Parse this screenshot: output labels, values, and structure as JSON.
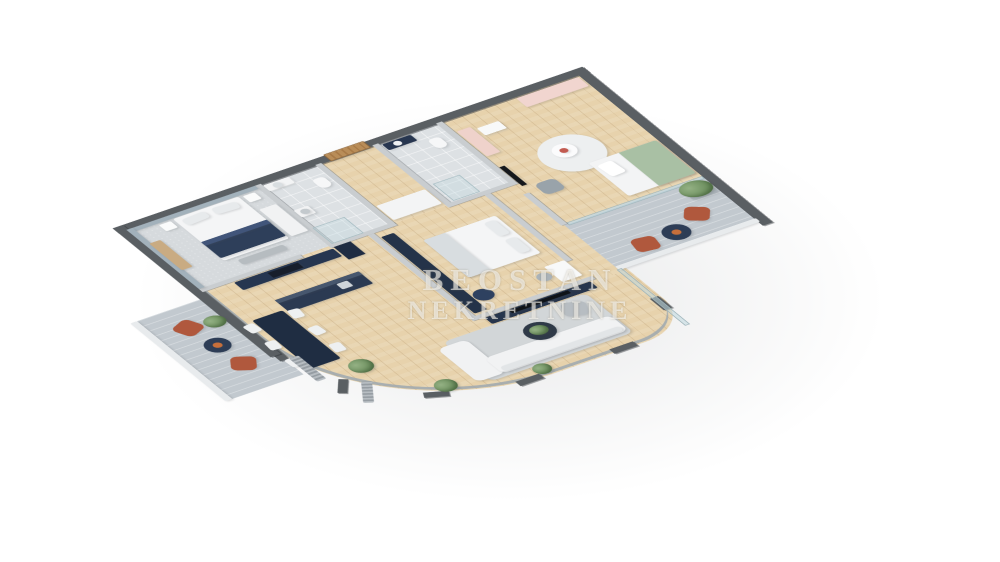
{
  "watermark": {
    "line1": "BEOSTAN",
    "line2": "NEKRETNINE"
  },
  "palette": {
    "background": "#ffffff",
    "exterior_wall": "#5a5f63",
    "interior_wall": "#c9cdd0",
    "wood_floor": "#e7d2ac",
    "tile_floor": "#dde1e4",
    "terrace_floor": "#c2c9cf",
    "navy_furniture": "#263650",
    "terracotta_chair": "#b0583d",
    "pink_furniture": "#f1d5cf",
    "green_bedding": "#a9c0a4",
    "plant_green": "#678a59"
  },
  "plan": {
    "width": 540,
    "height": 540,
    "items": [
      {
        "n": "living-kitchen-floor",
        "cls": "wood",
        "x": 0,
        "y": 136,
        "w": 380,
        "h": 324,
        "r": "0 0 60px 215px"
      },
      {
        "n": "hall-lower-floor",
        "cls": "wood",
        "x": 296,
        "y": 136,
        "w": 80,
        "h": 200
      },
      {
        "n": "master-bedroom-floor",
        "cls": "carpet",
        "x": 0,
        "y": 0,
        "w": 156,
        "h": 136
      },
      {
        "n": "bathroom-1-floor",
        "cls": "tile",
        "x": 156,
        "y": 0,
        "w": 72,
        "h": 136
      },
      {
        "n": "hallway-floor",
        "cls": "wood",
        "x": 228,
        "y": 0,
        "w": 68,
        "h": 136
      },
      {
        "n": "bathroom-2-floor",
        "cls": "tile",
        "x": 296,
        "y": 0,
        "w": 76,
        "h": 136
      },
      {
        "n": "kids-room-floor",
        "cls": "wood",
        "x": 372,
        "y": 0,
        "w": 168,
        "h": 230
      },
      {
        "n": "central-bedroom-floor",
        "cls": "wood",
        "x": 200,
        "y": 136,
        "w": 140,
        "h": 194
      },
      {
        "n": "right-terrace-floor",
        "cls": "terrace",
        "x": 372,
        "y": 230,
        "w": 168,
        "h": 100
      },
      {
        "n": "left-terrace-floor",
        "cls": "terrace",
        "x": -85,
        "y": 150,
        "w": 85,
        "h": 175
      },
      {
        "n": "curved-glass-wall",
        "cls": "glassring",
        "x": 0,
        "y": 136,
        "w": 376,
        "h": 322,
        "r": "0 0 60px 215px"
      },
      {
        "n": "window-pier-1",
        "cls": "wall",
        "x": -6,
        "y": 262,
        "w": 10,
        "h": 30
      },
      {
        "n": "window-pier-2",
        "cls": "wall",
        "x": 16,
        "y": 352,
        "w": 10,
        "h": 26,
        "rot": 35
      },
      {
        "n": "window-pier-3",
        "cls": "wall",
        "x": 78,
        "y": 424,
        "w": 26,
        "h": 10,
        "rot": 25
      },
      {
        "n": "window-pier-4",
        "cls": "wall",
        "x": 170,
        "y": 452,
        "w": 28,
        "h": 10
      },
      {
        "n": "window-pier-5",
        "cls": "wall",
        "x": 282,
        "y": 452,
        "w": 28,
        "h": 10
      },
      {
        "n": "window-pier-6",
        "cls": "wall",
        "x": 368,
        "y": 394,
        "w": 10,
        "h": 26
      },
      {
        "n": "exterior-wall-top",
        "cls": "wall",
        "x": -10,
        "y": -10,
        "w": 560,
        "h": 12
      },
      {
        "n": "exterior-wall-left",
        "cls": "wall",
        "x": -10,
        "y": -10,
        "w": 12,
        "h": 290
      },
      {
        "n": "exterior-wall-right",
        "cls": "wall",
        "x": 538,
        "y": -10,
        "w": 12,
        "h": 350
      },
      {
        "n": "right-terrace-parapet",
        "c": "#e8ebed",
        "x": 372,
        "y": 324,
        "w": 168,
        "h": 8,
        "r": "2px"
      },
      {
        "n": "left-terrace-parapet",
        "c": "#e8ebed",
        "x": -93,
        "y": 150,
        "w": 8,
        "h": 175,
        "r": "2px"
      },
      {
        "n": "kids-terrace-window",
        "cls": "glass",
        "x": 376,
        "y": 228,
        "w": 162,
        "h": 6
      },
      {
        "n": "living-terrace-window",
        "cls": "glass",
        "x": 370,
        "y": 330,
        "w": 6,
        "h": 126
      },
      {
        "n": "partition-bedroom-bath1",
        "cls": "iwall",
        "x": 153,
        "y": 0,
        "w": 7,
        "h": 136
      },
      {
        "n": "partition-bath1-hall",
        "cls": "iwall",
        "x": 225,
        "y": 0,
        "w": 7,
        "h": 136
      },
      {
        "n": "partition-hall-bath2",
        "cls": "iwall",
        "x": 293,
        "y": 0,
        "w": 7,
        "h": 136
      },
      {
        "n": "partition-bath2-kids",
        "cls": "iwall",
        "x": 369,
        "y": 0,
        "w": 7,
        "h": 136
      },
      {
        "n": "partition-kids-hall",
        "cls": "iwall",
        "x": 369,
        "y": 160,
        "w": 7,
        "h": 70
      },
      {
        "n": "partition-bedroom-kitchen",
        "cls": "iwall",
        "x": 0,
        "y": 133,
        "w": 120,
        "h": 7
      },
      {
        "n": "partition-bath1-center",
        "cls": "iwall",
        "x": 153,
        "y": 133,
        "w": 79,
        "h": 7
      },
      {
        "n": "partition-bath2-center",
        "cls": "iwall",
        "x": 293,
        "y": 133,
        "w": 83,
        "h": 7
      },
      {
        "n": "partition-centerroom-left",
        "cls": "iwall",
        "x": 197,
        "y": 140,
        "w": 7,
        "h": 190
      },
      {
        "n": "partition-centerroom-right",
        "cls": "iwall",
        "x": 336,
        "y": 140,
        "w": 7,
        "h": 150
      },
      {
        "n": "partition-centerroom-bottom",
        "cls": "iwall",
        "x": 197,
        "y": 326,
        "w": 146,
        "h": 7
      },
      {
        "n": "entrance-door",
        "cls": "door",
        "x": 242,
        "y": -12,
        "w": 48,
        "h": 15,
        "r": "2px"
      },
      {
        "n": "bedroom-accent-wall-top",
        "c": "#a2b1bb",
        "x": 0,
        "y": 0,
        "w": 153,
        "h": 7
      },
      {
        "n": "bedroom-accent-wall-left",
        "c": "#a2b1bb",
        "x": 0,
        "y": 0,
        "w": 7,
        "h": 133
      },
      {
        "n": "bedroom-dresser",
        "c": "#c9ab82",
        "x": 5,
        "y": 34,
        "w": 13,
        "h": 60,
        "r": "2px"
      },
      {
        "n": "master-bed",
        "c": "#f4f5f6",
        "x": 50,
        "y": 8,
        "w": 78,
        "h": 94,
        "r": "3px"
      },
      {
        "n": "master-bed-pillow-left",
        "c": "#e7eaec",
        "x": 56,
        "y": 13,
        "w": 28,
        "h": 13,
        "r": "4px",
        "rot": -4
      },
      {
        "n": "master-bed-pillow-right",
        "c": "#e7eaec",
        "x": 92,
        "y": 13,
        "w": 28,
        "h": 13,
        "r": "4px",
        "rot": 4
      },
      {
        "n": "master-bed-blanket",
        "c": "#2e3f5a",
        "x": 50,
        "y": 60,
        "w": 78,
        "h": 36,
        "r": "2px"
      },
      {
        "n": "master-bed-blanket-fold",
        "c": "#41557a",
        "x": 50,
        "y": 60,
        "w": 78,
        "h": 8
      },
      {
        "n": "nightstand-left",
        "c": "#fafbfb",
        "x": 32,
        "y": 10,
        "w": 14,
        "h": 14,
        "r": "2px"
      },
      {
        "n": "nightstand-right",
        "c": "#fafbfb",
        "x": 132,
        "y": 10,
        "w": 14,
        "h": 14,
        "r": "2px"
      },
      {
        "n": "bedroom-bench",
        "c": "#b6bcc0",
        "x": 62,
        "y": 108,
        "w": 54,
        "h": 11,
        "r": "3px"
      },
      {
        "n": "bedroom-wardrobe",
        "c": "#f1f2f3",
        "x": 132,
        "y": 40,
        "w": 20,
        "h": 60,
        "r": "2px"
      },
      {
        "n": "bathroom-1-vanity",
        "c": "#f3f4f5",
        "x": 160,
        "y": 4,
        "w": 30,
        "h": 13,
        "r": "2px"
      },
      {
        "n": "bathroom-1-sink",
        "c": "#d9dee1",
        "x": 168,
        "y": 6,
        "w": 10,
        "h": 10,
        "r": "50%"
      },
      {
        "n": "bathroom-1-toilet",
        "c": "#f6f7f8",
        "x": 206,
        "y": 22,
        "w": 14,
        "h": 20,
        "r": "5px 5px 7px 7px"
      },
      {
        "n": "washing-machine",
        "c": "#f2f3f4",
        "x": 160,
        "y": 60,
        "w": 17,
        "h": 16,
        "r": "2px"
      },
      {
        "n": "washing-machine-door",
        "c": "#c3c9cd",
        "x": 164,
        "y": 63,
        "w": 10,
        "h": 10,
        "r": "50%"
      },
      {
        "n": "bathroom-1-shower",
        "cls": "glassbox",
        "x": 158,
        "y": 98,
        "w": 38,
        "h": 36
      },
      {
        "n": "hall-cabinet",
        "c": "#f3f4f5",
        "x": 234,
        "y": 98,
        "w": 58,
        "h": 32,
        "r": "2px"
      },
      {
        "n": "bathroom-2-vanity",
        "c": "#273650",
        "x": 302,
        "y": 4,
        "w": 34,
        "h": 13,
        "r": "2px"
      },
      {
        "n": "bathroom-2-sink",
        "c": "#eef0f2",
        "x": 312,
        "y": 6,
        "w": 9,
        "h": 9,
        "r": "50%"
      },
      {
        "n": "bathroom-2-toilet",
        "c": "#f6f7f8",
        "x": 344,
        "y": 22,
        "w": 14,
        "h": 20,
        "r": "5px 5px 7px 7px"
      },
      {
        "n": "bathroom-2-shower",
        "cls": "glassbox",
        "x": 304,
        "y": 94,
        "w": 32,
        "h": 38
      },
      {
        "n": "kids-wardrobe",
        "c": "#f1d5cf",
        "x": 462,
        "y": 4,
        "w": 74,
        "h": 20,
        "r": "2px"
      },
      {
        "n": "kids-shelf",
        "c": "#efd2cb",
        "x": 378,
        "y": 24,
        "w": 16,
        "h": 56,
        "r": "2px"
      },
      {
        "n": "kids-desk",
        "c": "#f8f9f9",
        "x": 398,
        "y": 30,
        "w": 26,
        "h": 16,
        "r": "2px"
      },
      {
        "n": "kids-round-rug",
        "c": "#edeff0",
        "x": 418,
        "y": 86,
        "w": 70,
        "h": 70,
        "r": "50%"
      },
      {
        "n": "kids-round-table",
        "c": "#fbfbfc",
        "x": 436,
        "y": 100,
        "w": 26,
        "h": 26,
        "r": "50%"
      },
      {
        "n": "kids-toys",
        "c": "#c25a50",
        "x": 444,
        "y": 108,
        "w": 9,
        "h": 9,
        "r": "50%"
      },
      {
        "n": "kids-bed",
        "c": "#f3f4f5",
        "x": 456,
        "y": 146,
        "w": 80,
        "h": 74,
        "r": "3px"
      },
      {
        "n": "kids-bed-blanket",
        "c": "#a9c0a4",
        "x": 492,
        "y": 146,
        "w": 44,
        "h": 74,
        "r": "0 3px 3px 0"
      },
      {
        "n": "kids-bed-pillow",
        "c": "#ffffff",
        "x": 461,
        "y": 154,
        "w": 18,
        "h": 26,
        "r": "4px",
        "rot": -5
      },
      {
        "n": "kids-armchair",
        "c": "#99a3aa",
        "x": 388,
        "y": 150,
        "w": 24,
        "h": 24,
        "r": "7px"
      },
      {
        "n": "kids-tv",
        "c": "#15181c",
        "x": 377,
        "y": 104,
        "w": 6,
        "h": 42
      },
      {
        "n": "terrace-plant-pot",
        "c": "#a9b2b8",
        "x": 506,
        "y": 238,
        "w": 30,
        "h": 24,
        "r": "3px"
      },
      {
        "n": "terrace-plant",
        "cls": "plant",
        "x": 502,
        "y": 230,
        "w": 36,
        "h": 30
      },
      {
        "n": "terrace-chair-1",
        "c": "#b0583d",
        "x": 482,
        "y": 272,
        "w": 26,
        "h": 26,
        "r": "7px",
        "rot": 35
      },
      {
        "n": "terrace-chair-2",
        "c": "#b0583d",
        "x": 408,
        "y": 292,
        "w": 26,
        "h": 26,
        "r": "7px",
        "rot": 10
      },
      {
        "n": "terrace-table",
        "c": "#2d3d56",
        "x": 444,
        "y": 288,
        "w": 30,
        "h": 30,
        "r": "50%"
      },
      {
        "n": "terrace-bowl",
        "c": "#c76f3b",
        "x": 454,
        "y": 298,
        "w": 10,
        "h": 10,
        "r": "50%"
      },
      {
        "n": "kitchen-cabinets",
        "c": "#263650",
        "x": 36,
        "y": 142,
        "w": 118,
        "h": 17,
        "r": "2px"
      },
      {
        "n": "kitchen-cooktop",
        "c": "#171e2b",
        "x": 74,
        "y": 145,
        "w": 36,
        "h": 11
      },
      {
        "n": "kitchen-tall-unit",
        "c": "#1f2c42",
        "x": 156,
        "y": 140,
        "w": 20,
        "h": 28
      },
      {
        "n": "kitchen-island",
        "c": "#2b3a52",
        "x": 52,
        "y": 192,
        "w": 100,
        "h": 27,
        "r": "2px"
      },
      {
        "n": "kitchen-island-top",
        "c": "#47576e",
        "x": 52,
        "y": 192,
        "w": 100,
        "h": 7
      },
      {
        "n": "kitchen-sink",
        "c": "#cfd5da",
        "x": 120,
        "y": 200,
        "w": 13,
        "h": 12,
        "r": "2px"
      },
      {
        "n": "dining-table",
        "c": "#1f2d42",
        "x": 12,
        "y": 212,
        "w": 36,
        "h": 108,
        "r": "3px"
      },
      {
        "n": "dining-chair-1",
        "c": "#eef0f1",
        "x": -2,
        "y": 216,
        "w": 13,
        "h": 17,
        "r": "3px",
        "rot": -6
      },
      {
        "n": "dining-chair-2",
        "c": "#eef0f1",
        "x": -2,
        "y": 254,
        "w": 13,
        "h": 17,
        "r": "3px",
        "rot": 5
      },
      {
        "n": "dining-chair-3",
        "c": "#eef0f1",
        "x": -2,
        "y": 292,
        "w": 13,
        "h": 17,
        "r": "3px",
        "rot": -4
      },
      {
        "n": "dining-chair-4",
        "c": "#eef0f1",
        "x": 50,
        "y": 216,
        "w": 13,
        "h": 17,
        "r": "3px",
        "rot": 7
      },
      {
        "n": "dining-chair-5",
        "c": "#eef0f1",
        "x": 50,
        "y": 254,
        "w": 13,
        "h": 17,
        "r": "3px",
        "rot": -5
      },
      {
        "n": "dining-chair-6",
        "c": "#eef0f1",
        "x": 50,
        "y": 292,
        "w": 13,
        "h": 17,
        "r": "3px",
        "rot": 4
      },
      {
        "n": "center-wardrobe",
        "c": "#243349",
        "x": 206,
        "y": 150,
        "w": 15,
        "h": 172,
        "r": "2px"
      },
      {
        "n": "center-bed",
        "c": "#f4f5f6",
        "x": 238,
        "y": 178,
        "w": 86,
        "h": 84,
        "r": "3px"
      },
      {
        "n": "center-bed-pillow-1",
        "c": "#e7eaec",
        "x": 306,
        "y": 184,
        "w": 13,
        "h": 30,
        "r": "4px"
      },
      {
        "n": "center-bed-pillow-2",
        "c": "#e7eaec",
        "x": 306,
        "y": 222,
        "w": 13,
        "h": 30,
        "r": "4px"
      },
      {
        "n": "center-bed-throw",
        "c": "#d8dde0",
        "x": 238,
        "y": 178,
        "w": 26,
        "h": 84,
        "r": "3px 0 0 3px"
      },
      {
        "n": "center-pouf",
        "c": "#2e4160",
        "x": 222,
        "y": 286,
        "w": 22,
        "h": 22,
        "r": "50%"
      },
      {
        "n": "center-desk",
        "c": "#f8f9f9",
        "x": 312,
        "y": 286,
        "w": 24,
        "h": 34,
        "r": "2px"
      },
      {
        "n": "center-desk-chair",
        "c": "#aab3b9",
        "x": 294,
        "y": 294,
        "w": 16,
        "h": 16,
        "r": "50%"
      },
      {
        "n": "tv-wall-unit",
        "c": "#26354d",
        "x": 210,
        "y": 334,
        "w": 126,
        "h": 14,
        "r": "2px"
      },
      {
        "n": "living-tv",
        "c": "#0f1318",
        "x": 238,
        "y": 336,
        "w": 70,
        "h": 6
      },
      {
        "n": "living-rug",
        "c": "#d2d6d8",
        "x": 150,
        "y": 350,
        "w": 170,
        "h": 88,
        "r": "8px"
      },
      {
        "n": "sofa-chaise",
        "c": "#f1f2f3",
        "x": 138,
        "y": 358,
        "w": 34,
        "h": 74,
        "r": "8px"
      },
      {
        "n": "sofa",
        "c": "#f1f2f3",
        "x": 168,
        "y": 398,
        "w": 150,
        "h": 34,
        "r": "8px"
      },
      {
        "n": "sofa-back-cushions",
        "c": "#e2e5e7",
        "x": 172,
        "y": 420,
        "w": 142,
        "h": 10,
        "r": "4px"
      },
      {
        "n": "coffee-table",
        "c": "#2f3a48",
        "x": 226,
        "y": 368,
        "w": 34,
        "h": 34,
        "r": "50%"
      },
      {
        "n": "coffee-table-plant",
        "cls": "plant",
        "x": 233,
        "y": 374,
        "w": 20,
        "h": 18
      },
      {
        "n": "living-armchair",
        "c": "#b7bdc2",
        "x": 282,
        "y": 356,
        "w": 26,
        "h": 26,
        "r": "7px",
        "rot": 20
      },
      {
        "n": "floor-plant-1",
        "cls": "plant",
        "x": 44,
        "y": 330,
        "w": 26,
        "h": 26
      },
      {
        "n": "floor-plant-2",
        "cls": "plant",
        "x": 96,
        "y": 408,
        "w": 24,
        "h": 24
      },
      {
        "n": "floor-plant-3",
        "cls": "plant",
        "x": 196,
        "y": 436,
        "w": 20,
        "h": 20
      },
      {
        "n": "radiator-1",
        "cls": "radiator",
        "x": 4,
        "y": 292,
        "w": 11,
        "h": 52
      },
      {
        "n": "radiator-2",
        "cls": "radiator",
        "x": 30,
        "y": 368,
        "w": 11,
        "h": 40,
        "rot": 30
      },
      {
        "n": "terrace-chair-3",
        "c": "#b0583d",
        "x": -62,
        "y": 176,
        "w": 26,
        "h": 26,
        "r": "7px",
        "rot": -25
      },
      {
        "n": "terrace-chair-4",
        "c": "#b0583d",
        "x": -52,
        "y": 262,
        "w": 26,
        "h": 26,
        "r": "7px",
        "rot": -60
      },
      {
        "n": "terrace-table-2",
        "c": "#2d3d56",
        "x": -56,
        "y": 218,
        "w": 28,
        "h": 28,
        "r": "50%"
      },
      {
        "n": "terrace-bowl-2",
        "c": "#c76f3b",
        "x": -47,
        "y": 227,
        "w": 10,
        "h": 10,
        "r": "50%"
      },
      {
        "n": "terrace-plant-2",
        "cls": "plant",
        "x": -32,
        "y": 182,
        "w": 24,
        "h": 22
      }
    ]
  }
}
